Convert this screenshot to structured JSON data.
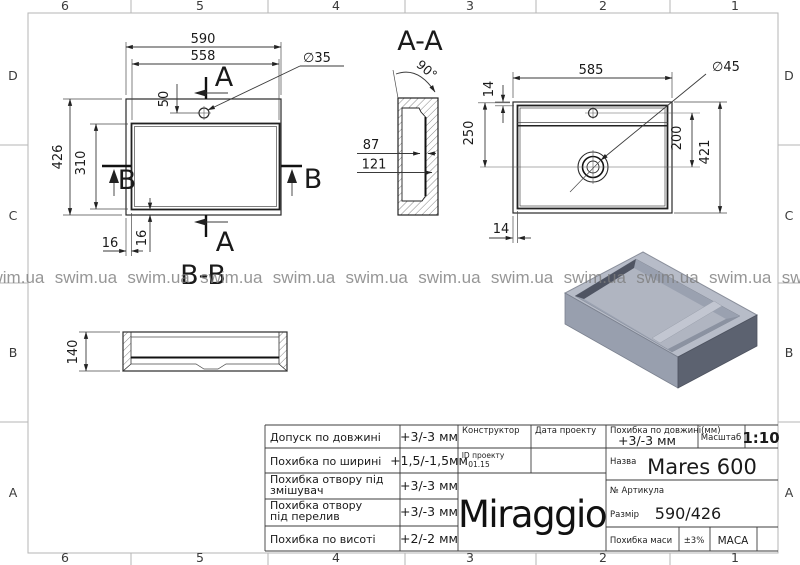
{
  "frame": {
    "columns": [
      "6",
      "5",
      "4",
      "3",
      "2",
      "1"
    ],
    "rows": [
      "D",
      "C",
      "B",
      "A"
    ]
  },
  "watermark": {
    "text": "swim.ua",
    "count": 12
  },
  "views": {
    "plan": {
      "dim_overall_width": "590",
      "dim_inner_width": "558",
      "dim_hole_dia": "∅35",
      "dim_hole_offset": "50",
      "dim_overall_height": "426",
      "dim_inner_height": "310",
      "dim_offset_bottom_h": "16",
      "dim_offset_bottom_v": "16",
      "marker_a": "A",
      "marker_b": "B"
    },
    "section_aa": {
      "title": "A-A",
      "dim_angle": "90°",
      "dim_inner_depth": "87",
      "dim_outer_depth": "121"
    },
    "bottom": {
      "dim_width": "585",
      "dim_rim_top": "14",
      "dim_drain_offset": "250",
      "dim_hole_to_drain": "200",
      "dim_overall_height": "421",
      "dim_rim_side": "14",
      "dim_drain_dia": "∅45"
    },
    "section_bb": {
      "title": "B-B",
      "dim_height": "140"
    }
  },
  "title_block": {
    "tolerances": [
      {
        "label_lines": [
          "Допуск по довжині"
        ],
        "value": "+3/-3 мм"
      },
      {
        "label_lines": [
          "Похибка по ширині"
        ],
        "value": "+1,5/-1,5мм"
      },
      {
        "label_lines": [
          "Похибка отвору під",
          "змішувач"
        ],
        "value": "+3/-3 мм"
      },
      {
        "label_lines": [
          "Похибка отвору",
          "під перелив"
        ],
        "value": "+3/-3 мм"
      },
      {
        "label_lines": [
          "Похибка по висоті"
        ],
        "value": "+2/-2 мм"
      }
    ],
    "constructor_label": "Конструктор",
    "date_label": "Дата проекту",
    "project_id_label": "ID проекту",
    "project_id_value": "01.15",
    "length_tol_label": "Похибка по довжині(мм)",
    "length_tol_value": "+3/-3 мм",
    "scale_label": "Масштаб",
    "scale_value": "1:10",
    "name_label": "Назва",
    "name_value": "Mares 600",
    "article_label": "№ Артикула",
    "size_label": "Размір",
    "size_value": "590/426",
    "mass_tol_label": "Похибка маси",
    "mass_tol_value": "±3%",
    "mass_label": "МАСА",
    "logo": "Miraggio"
  },
  "colors": {
    "line": "#2a2a2a",
    "frame": "#b5b5b5",
    "watermark": "#7d7d7d",
    "iso_top": "#b7bcc8",
    "iso_left": "#989fae",
    "iso_right": "#5c6270",
    "iso_basin_dark": "#4f5462",
    "iso_floor": "#b0b5c1"
  }
}
